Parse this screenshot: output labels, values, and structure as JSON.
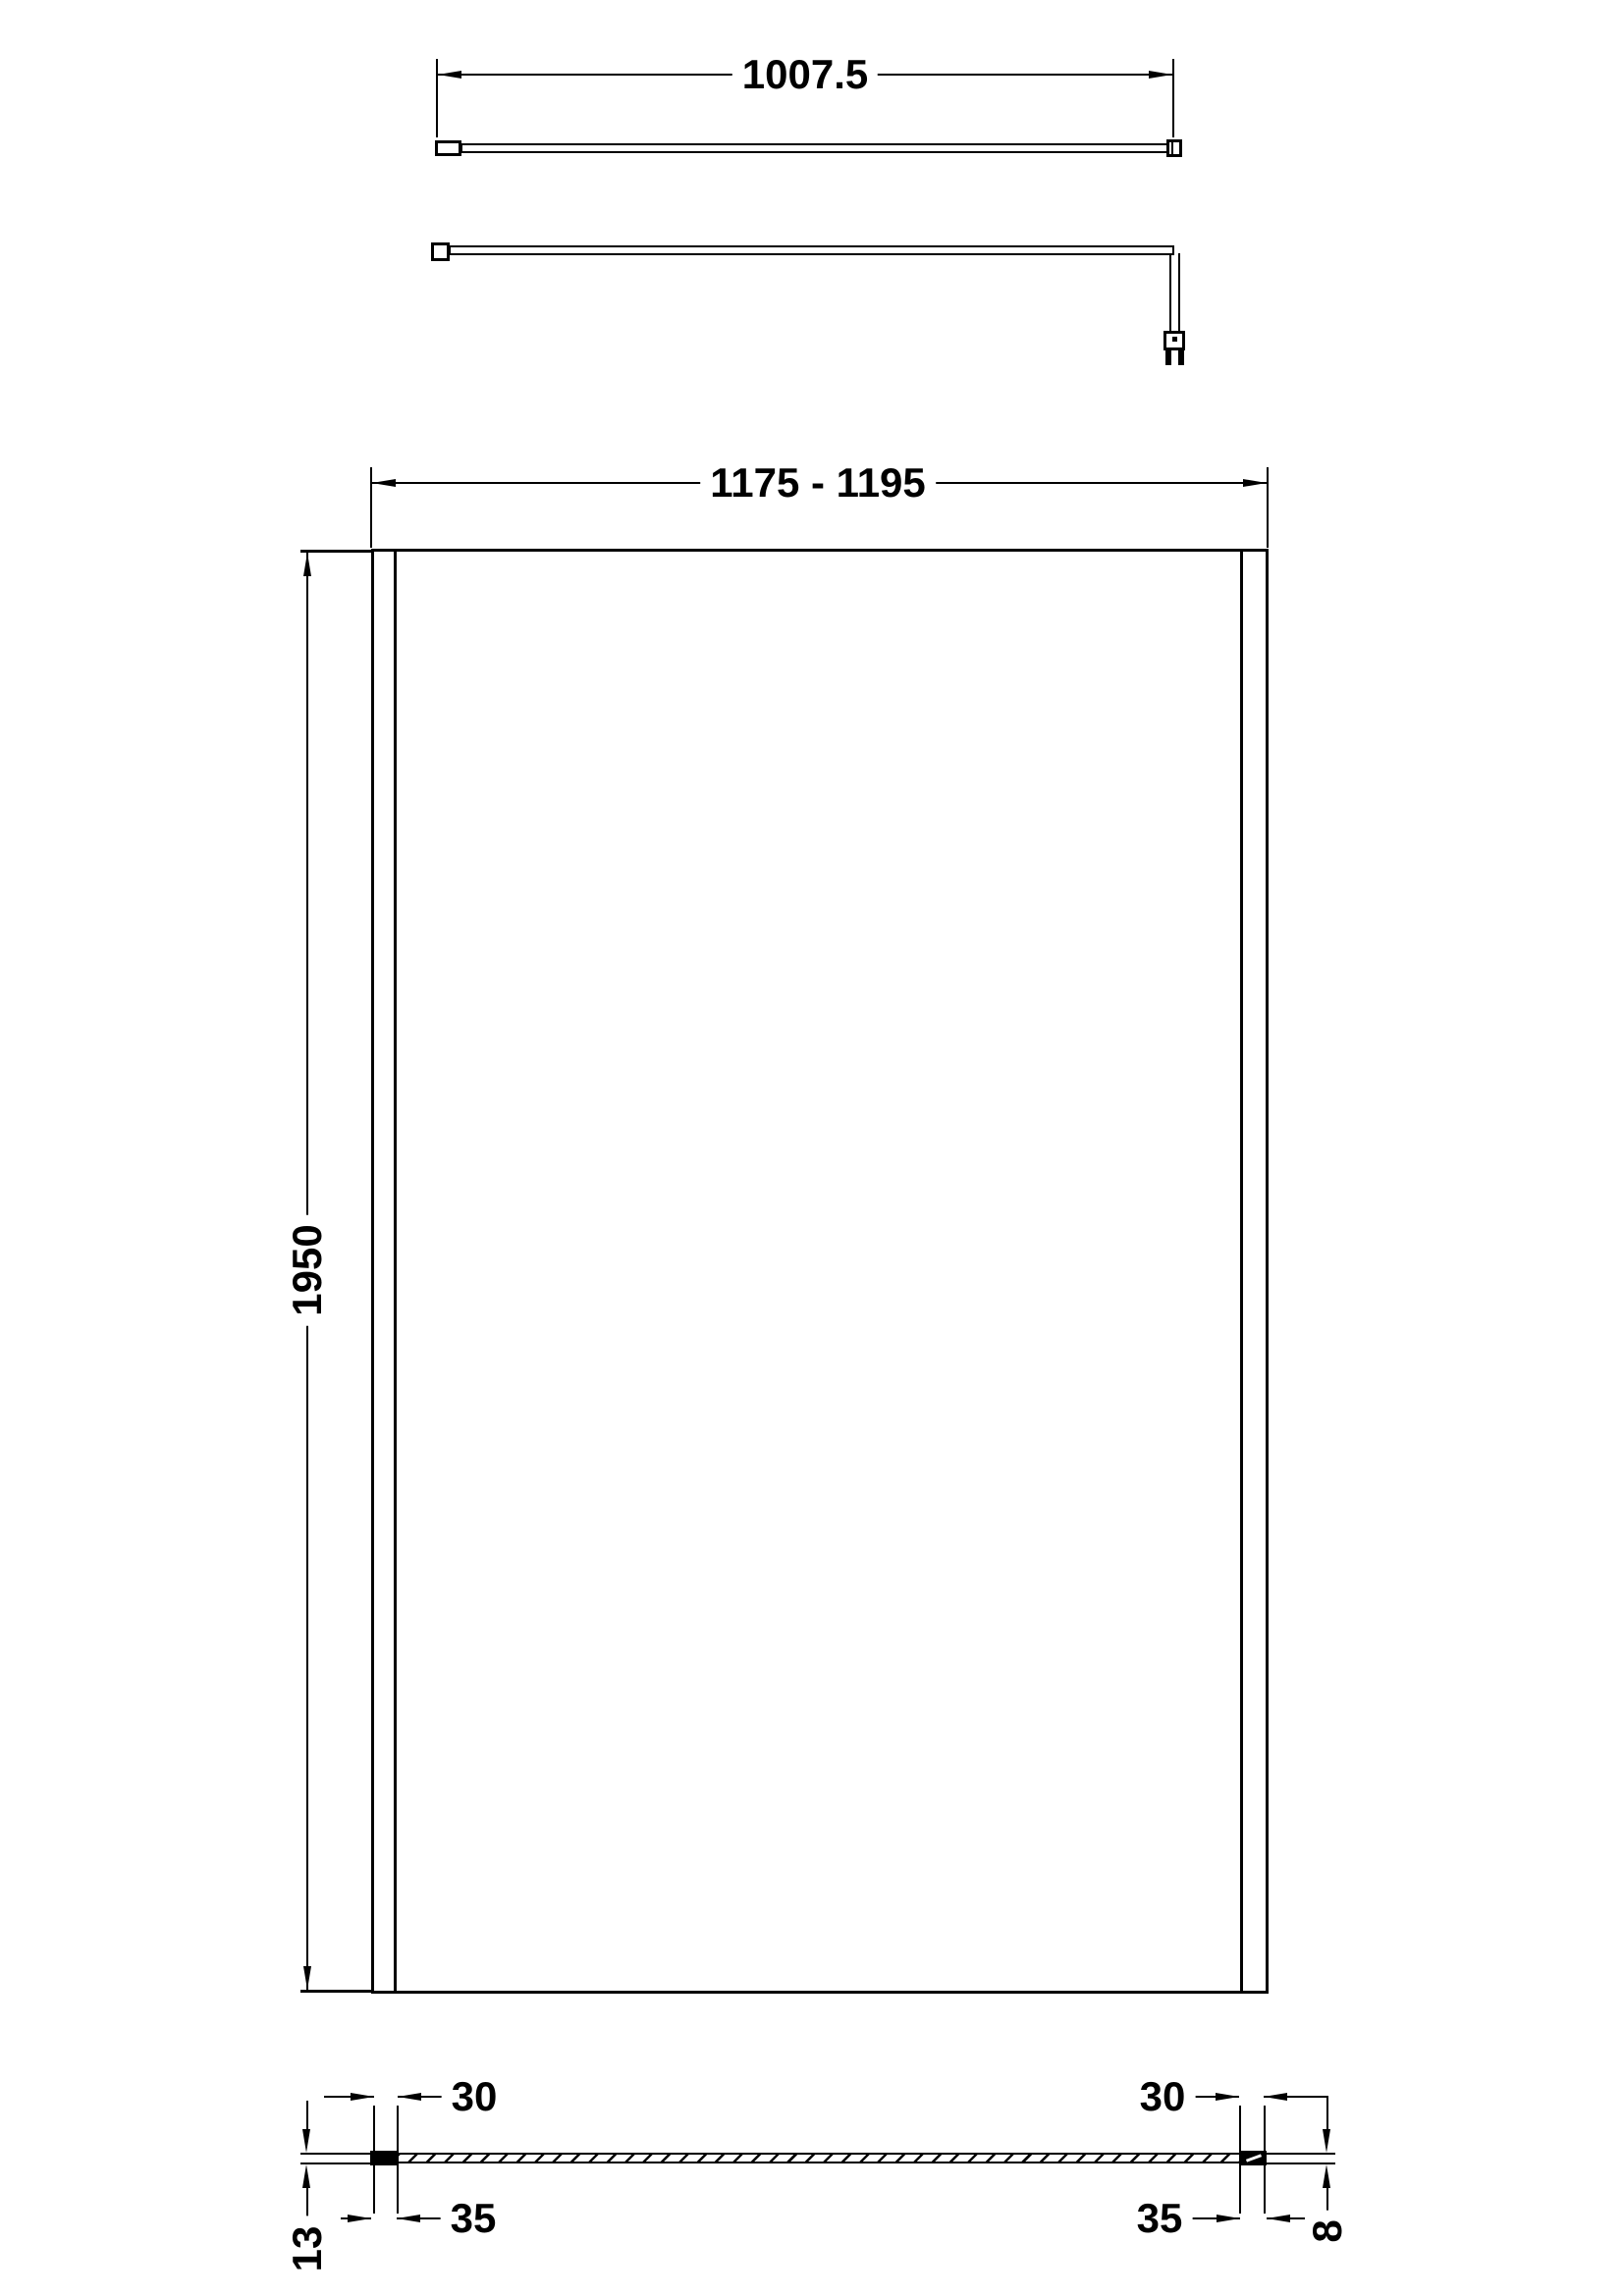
{
  "drawing": {
    "background": "#ffffff",
    "line_color": "#000000",
    "views": {
      "support_arm_plan": "plan view of wall support arm",
      "support_arm_elevation": "side view of wall support arm with glass clamp",
      "panel_front": "front view of wetroom glass screen",
      "panel_section": "horizontal section through glass and wall profiles"
    },
    "dimensions": {
      "support_arm_length": "1007.5",
      "overall_width": "1175 - 1195",
      "overall_height": "1950",
      "glass_inset_left": "30",
      "glass_inset_right": "30",
      "wall_profile_width_left": "35",
      "wall_profile_width_right": "35",
      "wall_profile_depth": "13",
      "glass_thickness": "8"
    }
  }
}
